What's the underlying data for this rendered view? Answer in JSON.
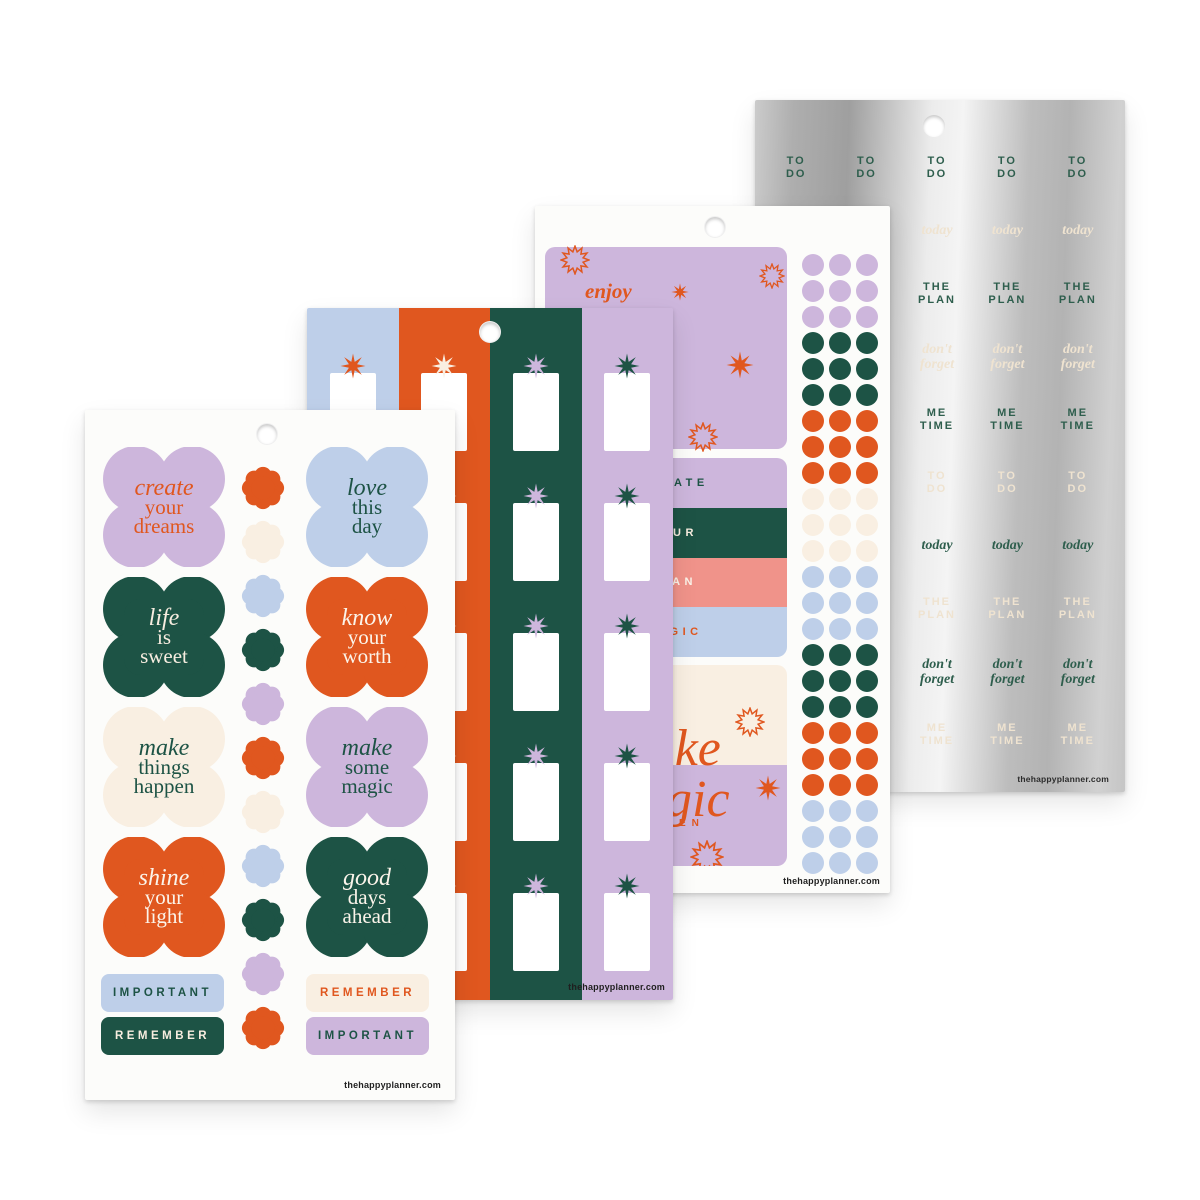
{
  "brand": {
    "url": "thehappyplanner.com"
  },
  "colors": {
    "orange": "#E0571F",
    "green": "#1D5345",
    "lavender": "#CDB6DC",
    "blue": "#BECFE9",
    "cream": "#F9EFE2",
    "salmon": "#F0938A",
    "cream_text": "#F7EDE0",
    "white_text": "#FBF4EA",
    "silver_green": "#2E5E4D",
    "silver_cream": "#EFE3D0",
    "footer_ink": "#1F1F1F"
  },
  "sheet1": {
    "quotes": [
      {
        "it": "create",
        "w2": "your",
        "w3": "dreams",
        "bg": "lavender",
        "fg": "orange"
      },
      {
        "it": "love",
        "w2": "this",
        "w3": "day",
        "bg": "blue",
        "fg": "green"
      },
      {
        "it": "life",
        "w2": "is",
        "w3": "sweet",
        "bg": "green",
        "fg": "cream_text"
      },
      {
        "it": "know",
        "w2": "your",
        "w3": "worth",
        "bg": "orange",
        "fg": "white_text"
      },
      {
        "it": "make",
        "w2": "things",
        "w3": "happen",
        "bg": "cream",
        "fg": "green"
      },
      {
        "it": "make",
        "w2": "some",
        "w3": "magic",
        "bg": "lavender",
        "fg": "green"
      },
      {
        "it": "shine",
        "w2": "your",
        "w3": "light",
        "bg": "orange",
        "fg": "white_text"
      },
      {
        "it": "good",
        "w2": "days",
        "w3": "ahead",
        "bg": "green",
        "fg": "white_text"
      }
    ],
    "labels": [
      {
        "text": "IMPORTANT",
        "bg": "blue",
        "fg": "green"
      },
      {
        "text": "REMEMBER",
        "bg": "green",
        "fg": "cream_text"
      },
      {
        "text": "REMEMBER",
        "bg": "cream",
        "fg": "orange"
      },
      {
        "text": "IMPORTANT",
        "bg": "lavender",
        "fg": "green"
      }
    ],
    "flowers": [
      "orange",
      "cream",
      "blue",
      "green",
      "lavender",
      "orange",
      "cream",
      "blue",
      "green",
      "lavender",
      "orange"
    ]
  },
  "sheet2": {
    "columns": [
      {
        "band": "blue",
        "star": "orange"
      },
      {
        "band": "orange",
        "star": "cream"
      },
      {
        "band": "green",
        "star": "lavender"
      },
      {
        "band": "lavender",
        "star": "green"
      }
    ]
  },
  "sheet3": {
    "enjoy": "enjoy",
    "strips": [
      {
        "text": "CREATE",
        "bg": "lavender",
        "fg": "green"
      },
      {
        "text": "YOUR",
        "bg": "green",
        "fg": "cream_text"
      },
      {
        "text": "PLAN",
        "bg": "salmon",
        "fg": "white_text"
      },
      {
        "text": "MAGIC",
        "bg": "blue",
        "fg": "orange"
      }
    ],
    "make_line1": "make",
    "make_line2": "magic",
    "happen": "HAPPEN",
    "dot_groups": [
      "lavender",
      "green",
      "orange",
      "cream",
      "blue",
      "green",
      "orange",
      "blue"
    ]
  },
  "sheet4": {
    "rows": [
      {
        "style": "caps",
        "color": "silver_green",
        "lines": [
          "TO",
          "DO"
        ]
      },
      {
        "style": "it",
        "color": "silver_cream",
        "lines": [
          "today"
        ]
      },
      {
        "style": "caps",
        "color": "silver_green",
        "lines": [
          "THE",
          "PLAN"
        ]
      },
      {
        "style": "it",
        "color": "silver_cream",
        "lines": [
          "don't",
          "forget"
        ]
      },
      {
        "style": "caps",
        "color": "silver_green",
        "lines": [
          "ME",
          "TIME"
        ]
      },
      {
        "style": "caps",
        "color": "silver_cream",
        "lines": [
          "TO",
          "DO"
        ]
      },
      {
        "style": "it",
        "color": "silver_green",
        "lines": [
          "today"
        ]
      },
      {
        "style": "caps",
        "color": "silver_cream",
        "lines": [
          "THE",
          "PLAN"
        ]
      },
      {
        "style": "it",
        "color": "silver_green",
        "lines": [
          "don't",
          "forget"
        ]
      },
      {
        "style": "caps",
        "color": "silver_cream",
        "lines": [
          "ME",
          "TIME"
        ]
      }
    ]
  }
}
